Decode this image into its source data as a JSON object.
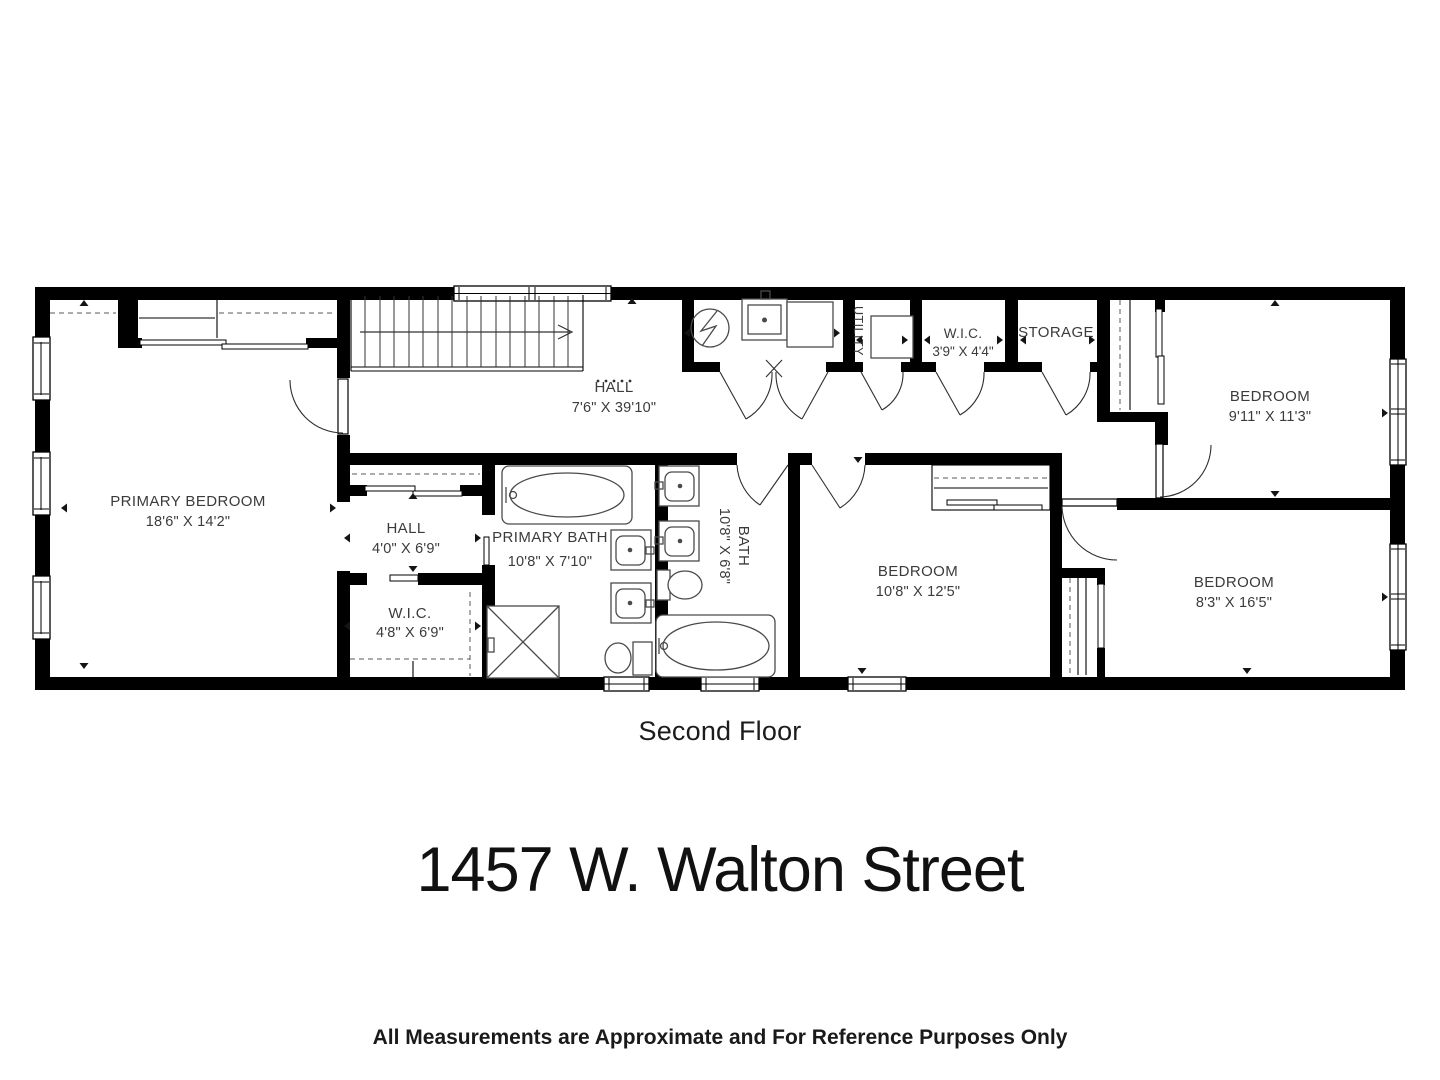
{
  "floor_label": "Second Floor",
  "address_title": "1457 W. Walton Street",
  "disclaimer": "All Measurements are Approximate and For Reference Purposes Only",
  "rooms": {
    "primary_bedroom": {
      "name": "PRIMARY BEDROOM",
      "dims": "18'6\" X 14'2\""
    },
    "hall_main": {
      "name": "HALL",
      "dims": "7'6\" X 39'10\""
    },
    "hall_small": {
      "name": "HALL",
      "dims": "4'0\" X 6'9\""
    },
    "wic_primary": {
      "name": "W.I.C.",
      "dims": "4'8\" X 6'9\""
    },
    "primary_bath": {
      "name": "PRIMARY BATH",
      "dims": "10'8\" X 7'10\""
    },
    "bath": {
      "name": "BATH",
      "dims": "10'8\" X 6'8\""
    },
    "utility": {
      "name": "UTILITY"
    },
    "wic_small": {
      "name": "W.I.C.",
      "dims": "3'9\" X 4'4\""
    },
    "storage": {
      "name": "STORAGE"
    },
    "bedroom_ne": {
      "name": "BEDROOM",
      "dims": "9'11\" X 11'3\""
    },
    "bedroom_mid": {
      "name": "BEDROOM",
      "dims": "10'8\" X 12'5\""
    },
    "bedroom_se": {
      "name": "BEDROOM",
      "dims": "8'3\" X 16'5\""
    }
  },
  "colors": {
    "wall": "#000000",
    "fixture_line": "#4a4a4a",
    "label_text": "#3b3b3b",
    "background": "#ffffff"
  }
}
